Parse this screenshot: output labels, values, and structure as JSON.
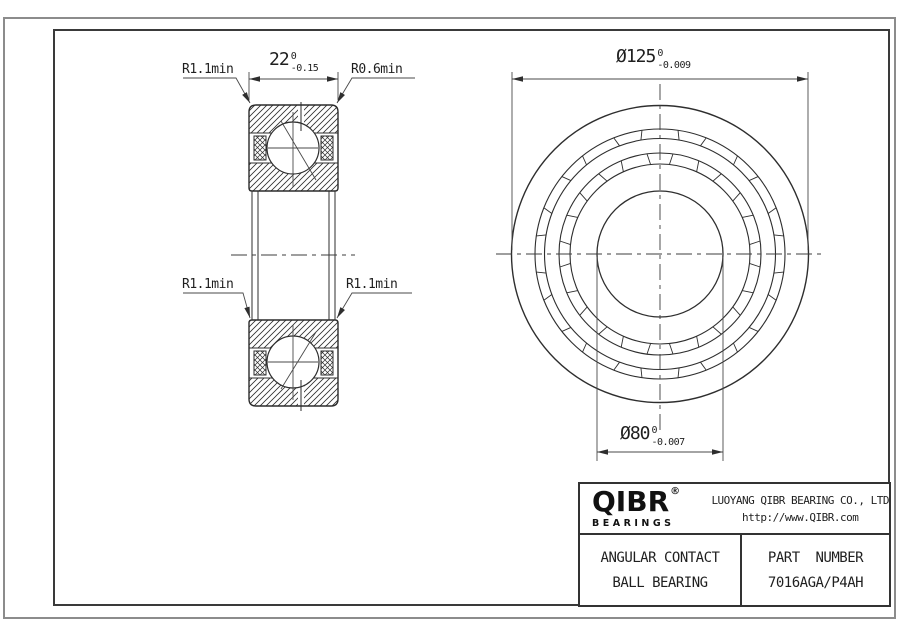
{
  "page": {
    "type": "engineering-drawing",
    "background": "#ffffff"
  },
  "views": {
    "section_view": {
      "dim_width": {
        "value": "22",
        "tol_upper": "0",
        "tol_lower": "-0.15"
      },
      "labels": {
        "top_left": "R1.1min",
        "top_right": "R0.6min",
        "mid_left": "R1.1min",
        "mid_right": "R1.1min"
      }
    },
    "front_view": {
      "dim_outer_diameter": {
        "value": "Ø125",
        "tol_upper": "0",
        "tol_lower": "-0.009"
      },
      "dim_bore_diameter": {
        "value": "Ø80",
        "tol_upper": "0",
        "tol_lower": "-0.007"
      }
    }
  },
  "title_block": {
    "logo": {
      "text": "QIBR",
      "registered": "®",
      "subtext": "BEARINGS"
    },
    "company": "LUOYANG QIBR BEARING CO., LTD",
    "website": "http://www.QIBR.com",
    "product_line1": "ANGULAR CONTACT",
    "product_line2": "BALL BEARING",
    "part_label": "PART  NUMBER",
    "part_number": "7016AGA/P4AH"
  },
  "colors": {
    "line": "#2e2e2e",
    "dim_line": "#4a4a4a",
    "text": "#1f1f1f",
    "frame_outer": "#8c8c8c",
    "frame_inner": "#3a3a3a",
    "background": "#ffffff"
  }
}
